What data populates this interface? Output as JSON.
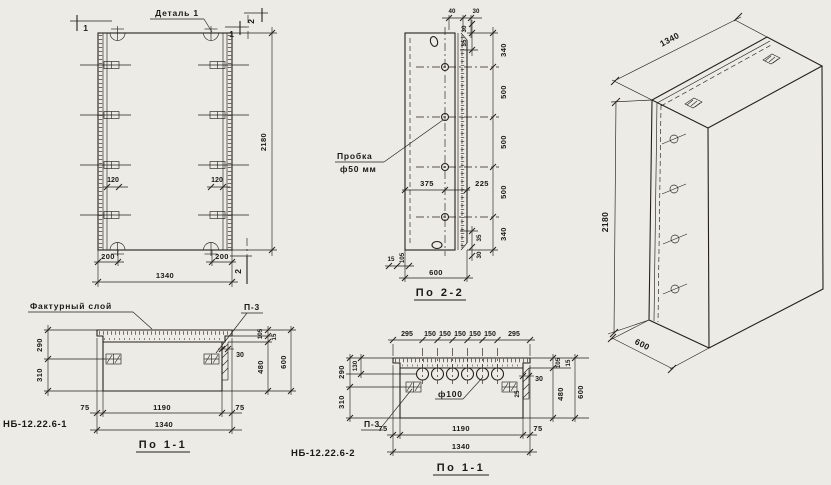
{
  "colors": {
    "paper": "#ecebe6",
    "ink": "#24211d"
  },
  "front": {
    "detail_label": "Деталь 1",
    "mark_1_left": "1",
    "mark_1_right": "1",
    "mark_2_top": "2",
    "mark_2_bottom": "2",
    "dim_120_left": "120",
    "dim_120_right": "120",
    "dim_200_left": "200",
    "dim_200_right": "200",
    "dim_width": "1340",
    "dim_height": "2180"
  },
  "s22": {
    "title": "По 2-2",
    "plug_line1": "Пробка",
    "plug_line2": "ф50 мм",
    "top": {
      "d40": "40",
      "d30": "30"
    },
    "topright": {
      "d30": "30",
      "d35": "35"
    },
    "chain": [
      "340",
      "500",
      "500",
      "500",
      "340"
    ],
    "bottomright": {
      "d35": "35",
      "d30": "30"
    },
    "mid": {
      "d375": "375",
      "d225": "225"
    },
    "bottom": {
      "d15": "15",
      "d105": "105",
      "d600": "600"
    }
  },
  "iso": {
    "dim_length": "1340",
    "dim_height": "2180",
    "dim_depth": "600"
  },
  "s11a": {
    "title": "По 1-1",
    "name": "НБ-12.22.6-1",
    "factur_label": "Фактурный слой",
    "p3_label": "П-3",
    "left": {
      "d290": "290",
      "d310": "310"
    },
    "right": {
      "d105": "105",
      "d15": "15",
      "d480": "480",
      "d600": "600",
      "d30": "30"
    },
    "bottom": {
      "d75l": "75",
      "d1190": "1190",
      "d75r": "75",
      "d1340": "1340"
    }
  },
  "s11b": {
    "title": "По 1-1",
    "name": "НБ-12.22.6-2",
    "p3_label": "П-3",
    "hole_label": "ф100",
    "top_dims": [
      "295",
      "150",
      "150",
      "150",
      "150",
      "150",
      "295"
    ],
    "left": {
      "d130": "130",
      "d290": "290",
      "d310": "310"
    },
    "right": {
      "d30": "30",
      "d25": "25",
      "d105": "105",
      "d15": "15",
      "d480": "480",
      "d600": "600"
    },
    "bottom": {
      "d75l": "75",
      "d1190": "1190",
      "d75r": "75",
      "d1340": "1340"
    }
  }
}
